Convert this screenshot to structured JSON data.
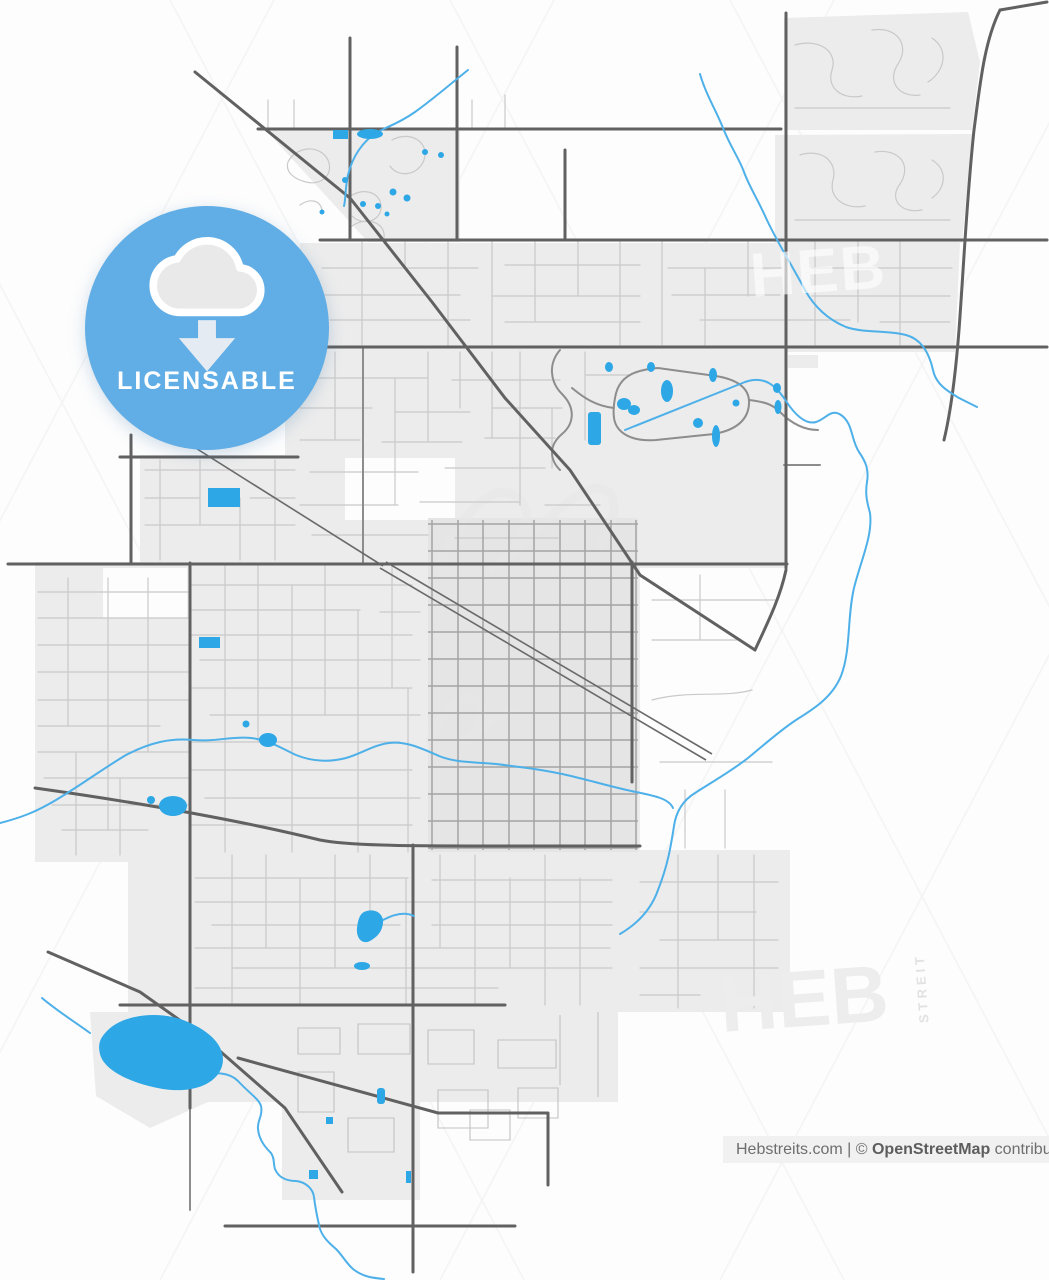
{
  "badge": {
    "label": "LICENSABLE",
    "icon": "cloud-download-icon"
  },
  "watermarks": {
    "brand": "HEB",
    "brand_vertical": "STREIT"
  },
  "attribution": {
    "source": "Hebstreits.com",
    "separator": " | ",
    "copyright": "© ",
    "osm": "OpenStreetMap",
    "suffix": " contributors"
  },
  "colors": {
    "badge_blue": "#61ade5",
    "water": "#2da7e5",
    "stream": "#4db0e9",
    "urban": "#ececec",
    "road_major": "#616161",
    "road_medium": "#8d8d8d",
    "road_minor": "#c9c9c9",
    "attribution_bg": "#f1f1f1",
    "attribution_text": "#6e6e6e",
    "watermark_gray": "#ededed"
  }
}
